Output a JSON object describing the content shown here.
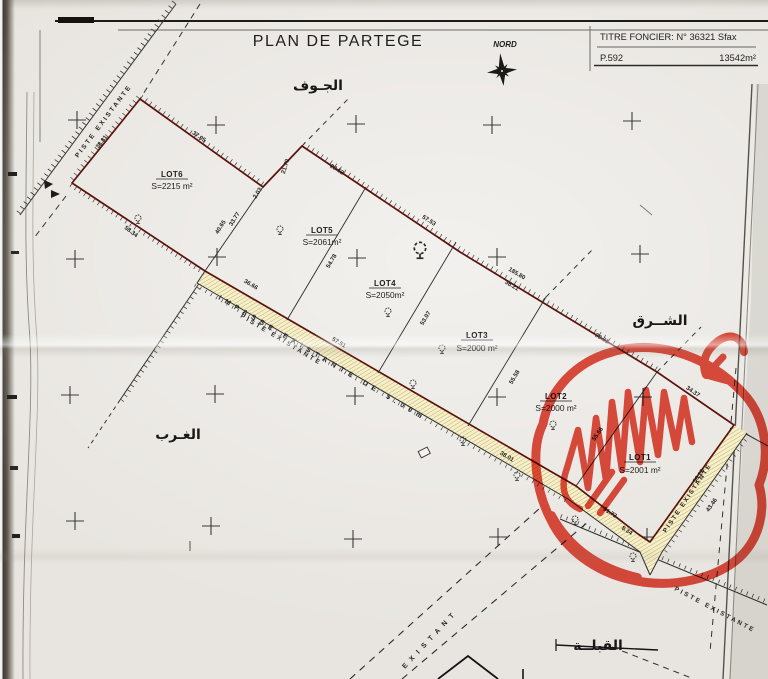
{
  "page": {
    "title": "PLAN DE PARTEGE"
  },
  "compass": {
    "label": "NORD"
  },
  "title_block": {
    "line1": "TITRE FONCIER: N° 36321 Sfax",
    "parcel_ref": "P.592",
    "total_area": "13542m²"
  },
  "directions": {
    "north": "الجـوف",
    "east": "الشــرق",
    "west": "الغـرب",
    "south": "القبلــة"
  },
  "lots": [
    {
      "name": "LOT1",
      "area": "S=2001 m²"
    },
    {
      "name": "LOT2",
      "area": "S=2000 m²"
    },
    {
      "name": "LOT3",
      "area": "S=2000 m²"
    },
    {
      "name": "LOT4",
      "area": "S=2050m²"
    },
    {
      "name": "LOT5",
      "area": "S=2061m²"
    },
    {
      "name": "LOT6",
      "area": "S=2215 m²"
    }
  ],
  "roads": {
    "piste_nw": "PISTE EXISTANTE",
    "impasse": "IMPASSE EXISTANTE DE 5.00m",
    "piste_impasse_side": "PISTE EXISTANTE",
    "piste_lot1": "PISTE EXISTANTE",
    "piste_se": "PISTE EXISTANTE",
    "existant": "EXISTANT"
  },
  "measurements": [
    "38.81",
    "37.05",
    "58.34",
    "40.65",
    "33.77",
    "2.03",
    "21.70",
    "23.53",
    "57.53",
    "185.80",
    "38.21",
    "38.01",
    "54.78",
    "53.07",
    "55.58",
    "55.66",
    "34.37",
    "50.12",
    "43.46",
    "31.73",
    "8.34",
    "36.66",
    "57.51",
    "38.01"
  ],
  "marker": {
    "color": "#e23b2b",
    "highlights": "LOT1"
  },
  "colors": {
    "boundary": "#5a120b",
    "strip_fill": "#f6efc7",
    "line": "#2e2c2a"
  }
}
